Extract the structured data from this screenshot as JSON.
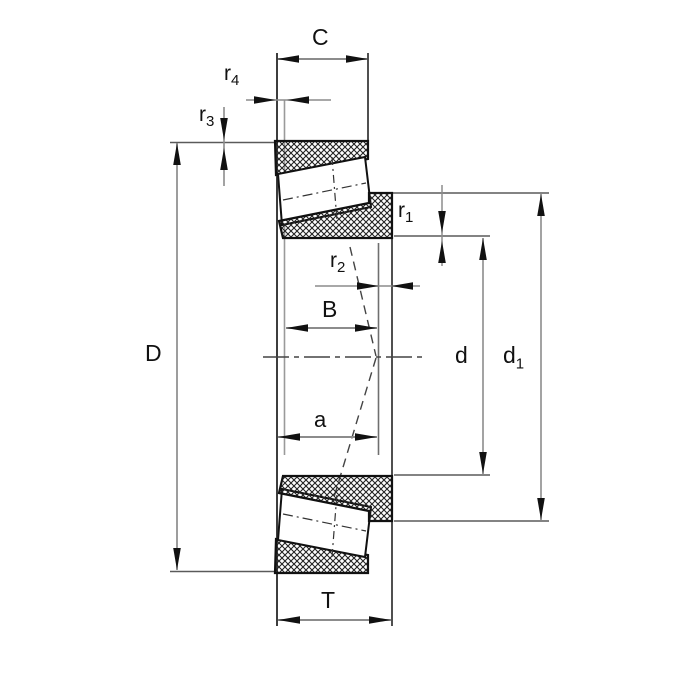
{
  "dims": {
    "C": {
      "main": "C",
      "sub": ""
    },
    "r4": {
      "main": "r",
      "sub": "4"
    },
    "r3": {
      "main": "r",
      "sub": "3"
    },
    "D": {
      "main": "D",
      "sub": ""
    },
    "B": {
      "main": "B",
      "sub": ""
    },
    "a": {
      "main": "a",
      "sub": ""
    },
    "T": {
      "main": "T",
      "sub": ""
    },
    "r1": {
      "main": "r",
      "sub": "1"
    },
    "r2": {
      "main": "r",
      "sub": "2"
    },
    "d": {
      "main": "d",
      "sub": ""
    },
    "d1": {
      "main": "d",
      "sub": "1"
    }
  },
  "colors": {
    "background": "#ffffff",
    "part_outline": "#111111",
    "hatch_line": "#222222",
    "dimension_line": "#8c8c8c",
    "extension_line": "#5a5a5a",
    "arrow": "#111111",
    "label_text": "#111111"
  }
}
